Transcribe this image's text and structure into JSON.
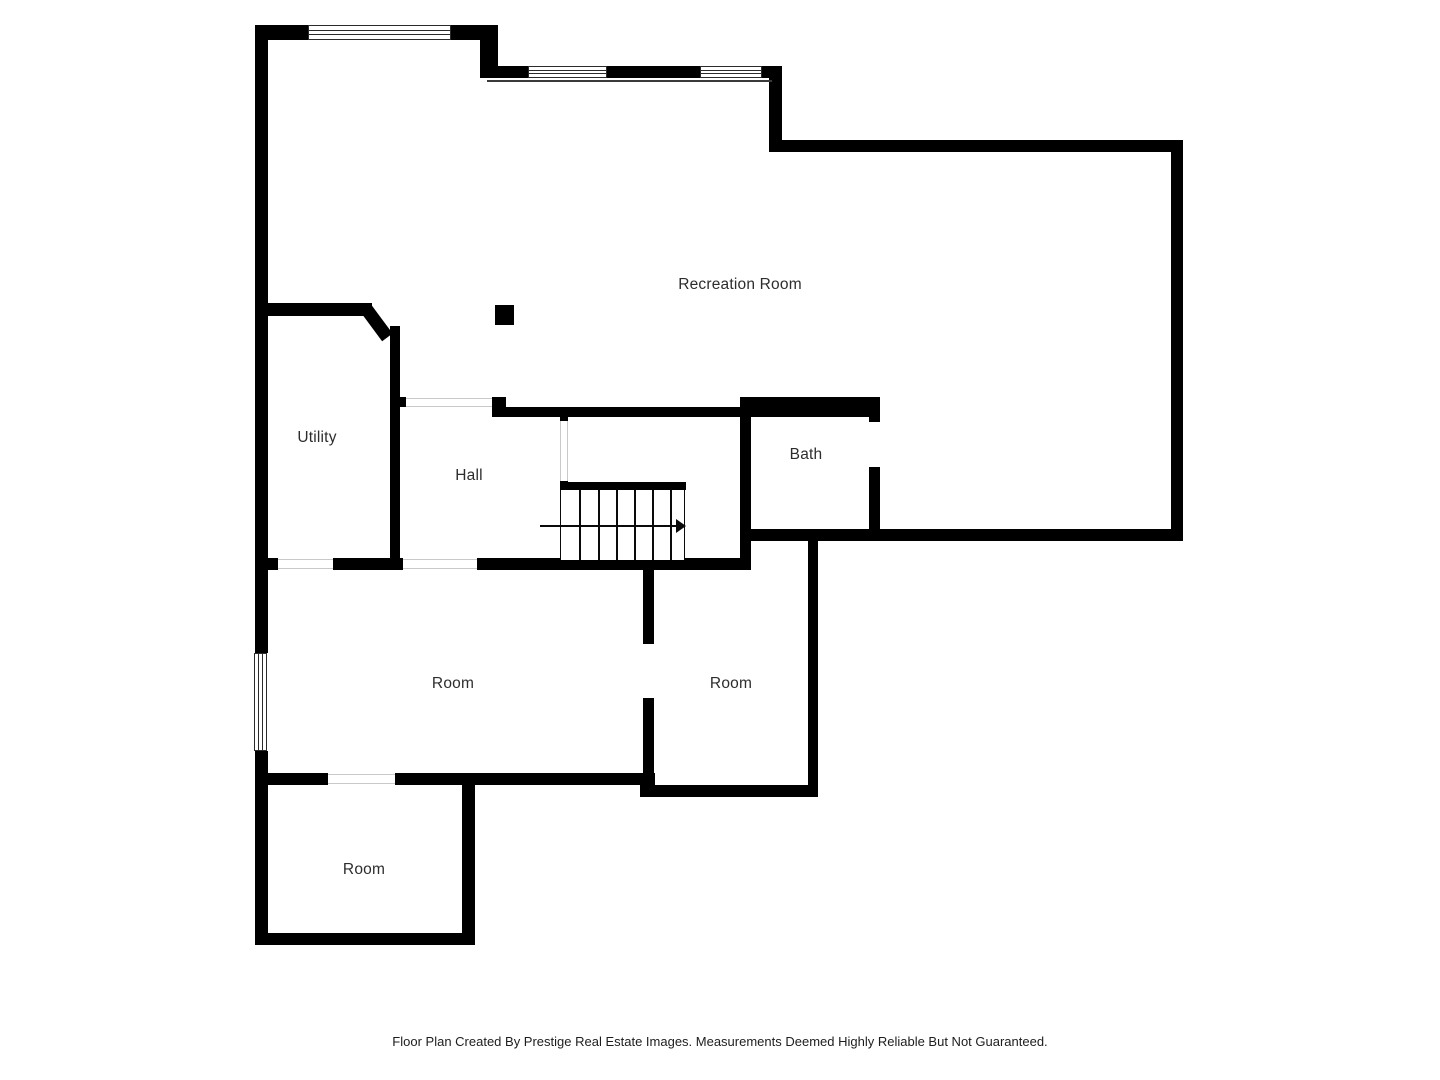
{
  "rooms": {
    "recreation": {
      "label": "Recreation Room"
    },
    "utility": {
      "label": "Utility"
    },
    "hall": {
      "label": "Hall"
    },
    "bath": {
      "label": "Bath"
    },
    "room_center": {
      "label": "Room"
    },
    "room_right": {
      "label": "Room"
    },
    "room_bottom": {
      "label": "Room"
    }
  },
  "stairs": {
    "direction": "right"
  },
  "footer": {
    "text": "Floor Plan Created By Prestige Real Estate Images. Measurements Deemed Highly Reliable But Not Guaranteed."
  },
  "colors": {
    "wall": "#000000",
    "background": "#ffffff",
    "label_text": "#2d2d2d",
    "opening_line": "#c9c9c9",
    "footer_text": "#1d1d1d"
  }
}
